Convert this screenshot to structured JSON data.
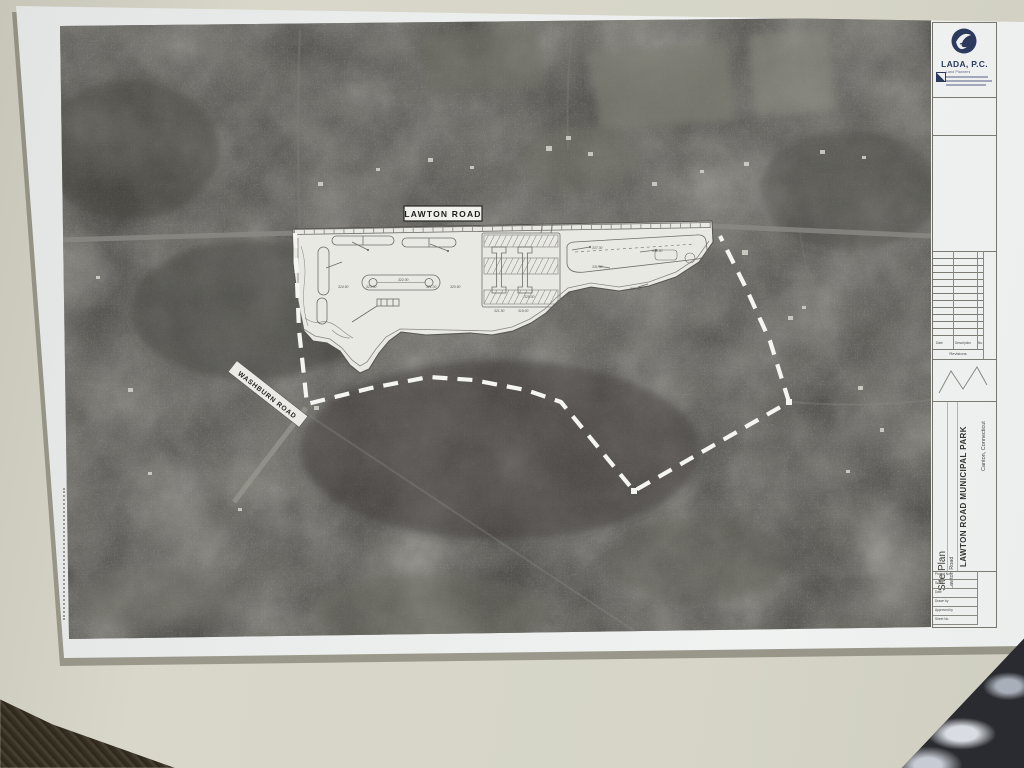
{
  "scene": {
    "background_color": "#d6d5c7",
    "paper_color": "#edf0ef",
    "aerial_base_color": "#4c4b48",
    "boundary_color": "#f4f4f0",
    "accent_navy": "#2c3a5e"
  },
  "aerial": {
    "main_road_label": "LAWTON ROAD",
    "side_road_label": "WASHBURN ROAD"
  },
  "plan": {
    "annotations": [
      "324.50",
      "323.00",
      "322.00",
      "321.00",
      "320.50",
      "337.00",
      "334.50",
      "331.00",
      "327.00",
      "325.00",
      "321.50",
      "319.00"
    ]
  },
  "title_block": {
    "firm": {
      "name": "LADA, P.C.",
      "tagline": "Land Planners"
    },
    "revisions": {
      "columns": [
        "Date",
        "Description",
        "No."
      ],
      "label": "Revisions"
    },
    "project": {
      "sheet_title": "Site Plan",
      "name": "LAWTON ROAD MUNICIPAL PARK",
      "street": "Lawton Road",
      "location": "Canton, Connecticut"
    },
    "info_rows": [
      {
        "label": "Project No."
      },
      {
        "label": "Scale"
      },
      {
        "label": "Date"
      },
      {
        "label": "Drawn by"
      },
      {
        "label": "Approved by"
      },
      {
        "label": "Sheet No."
      }
    ]
  }
}
